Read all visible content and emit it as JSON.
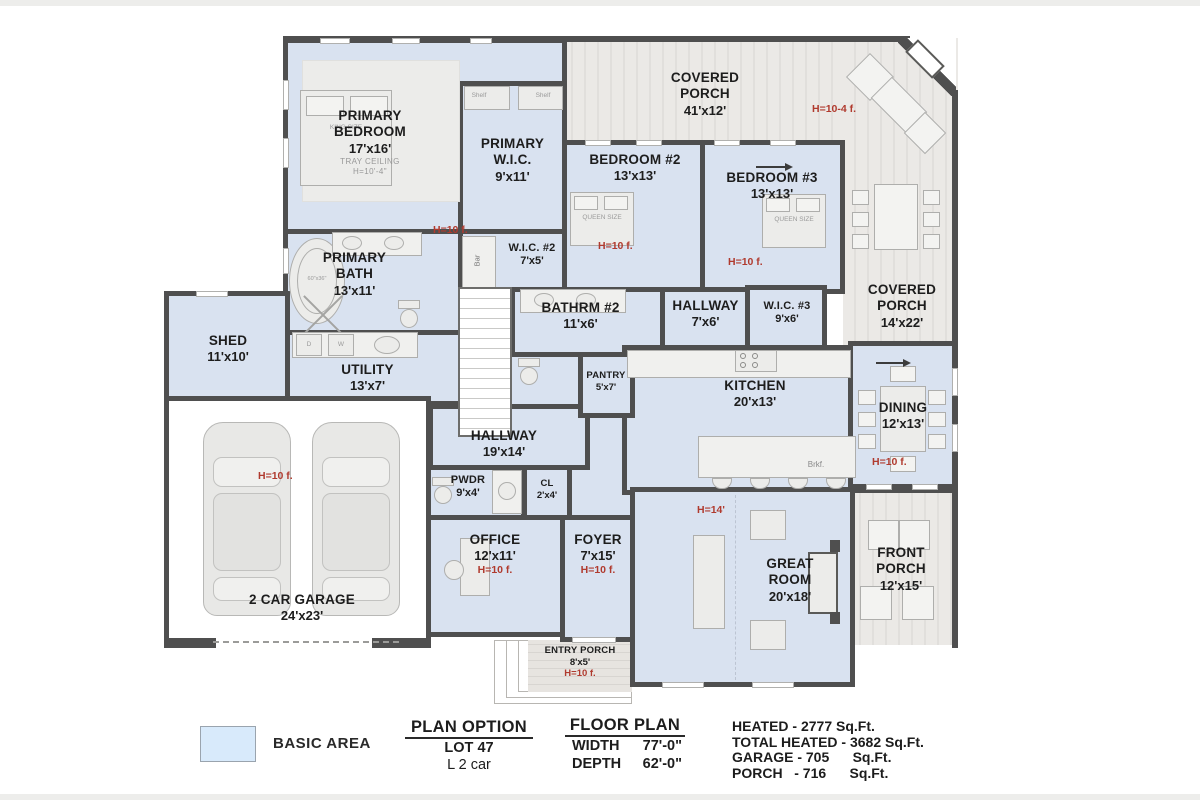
{
  "colors": {
    "wall": "#4f4f4f",
    "room": "#d9e2f0",
    "porch": "#ebe9e6",
    "porch_stripe": "#e1dfdc",
    "red": "#b03a2e",
    "legend_swatch": "#d8eafb"
  },
  "rooms": {
    "primary_bedroom": {
      "name": "PRIMARY BEDROOM",
      "dims": "17'x16'",
      "sub1": "TRAY CEILING",
      "sub2": "H=10'-4\""
    },
    "primary_wic": {
      "name": "PRIMARY W.I.C.",
      "dims": "9'x11'"
    },
    "primary_bath": {
      "name": "PRIMARY BATH",
      "dims": "13'x11'",
      "note": "H=10 f."
    },
    "wic2": {
      "name": "W.I.C. #2",
      "dims": "7'x5'"
    },
    "bedroom2": {
      "name": "BEDROOM #2",
      "dims": "13'x13'",
      "note": "H=10 f."
    },
    "bedroom3": {
      "name": "BEDROOM #3",
      "dims": "13'x13'",
      "note": "H=10 f."
    },
    "covered_porch_top": {
      "name": "COVERED PORCH",
      "dims": "41'x12'",
      "note": "H=10-4 f."
    },
    "covered_porch_right": {
      "name": "COVERED PORCH",
      "dims": "14'x22'"
    },
    "shed": {
      "name": "SHED",
      "dims": "11'x10'"
    },
    "utility": {
      "name": "UTILITY",
      "dims": "13'x7'"
    },
    "bathrm2": {
      "name": "BATHRM #2",
      "dims": "11'x6'"
    },
    "hallway_small": {
      "name": "HALLWAY",
      "dims": "7'x6'"
    },
    "wic3": {
      "name": "W.I.C. #3",
      "dims": "9'x6'"
    },
    "kitchen": {
      "name": "KITCHEN",
      "dims": "20'x13'"
    },
    "dining": {
      "name": "DINING",
      "dims": "12'x13'",
      "note": "H=10 f."
    },
    "hallway_main": {
      "name": "HALLWAY",
      "dims": "19'x14'"
    },
    "pwdr": {
      "name": "PWDR",
      "dims": "9'x4'"
    },
    "cl": {
      "name": "CL",
      "dims": "2'x4'"
    },
    "pantry": {
      "name": "PANTRY",
      "dims": "5'x7'"
    },
    "office": {
      "name": "OFFICE",
      "dims": "12'x11'",
      "note": "H=10 f."
    },
    "foyer": {
      "name": "FOYER",
      "dims": "7'x15'",
      "note": "H=10 f."
    },
    "great_room": {
      "name": "GREAT ROOM",
      "dims": "20'x18'",
      "note": "H=14'"
    },
    "front_porch": {
      "name": "FRONT PORCH",
      "dims": "12'x15'"
    },
    "garage": {
      "name": "2 CAR GARAGE",
      "dims": "24'x23'",
      "note": "H=10 f."
    },
    "entry_porch": {
      "name": "ENTRY PORCH",
      "dims": "8'x5'",
      "note": "H=10 f."
    }
  },
  "furniture": {
    "king_bed": "KING SIZE",
    "queen_bed": "QUEEN SIZE",
    "bar": "Bar",
    "shelf": "Shelf",
    "breakfast": "Brkf.",
    "dryer": "D",
    "washer": "W",
    "tub_size": "60\"x36\""
  },
  "legend": {
    "basic_area": "BASIC AREA"
  },
  "plan_option": {
    "title": "PLAN OPTION",
    "lot": "LOT 47",
    "option": "L 2 car"
  },
  "floor_plan": {
    "title": "FLOOR PLAN",
    "width_label": "WIDTH",
    "width_value": "77'-0\"",
    "depth_label": "DEPTH",
    "depth_value": "62'-0\""
  },
  "stats": {
    "lines": [
      "HEATED - 2777 Sq.Ft.",
      "TOTAL HEATED - 3682 Sq.Ft.",
      "GARAGE - 705      Sq.Ft.",
      "PORCH   - 716      Sq.Ft."
    ]
  }
}
